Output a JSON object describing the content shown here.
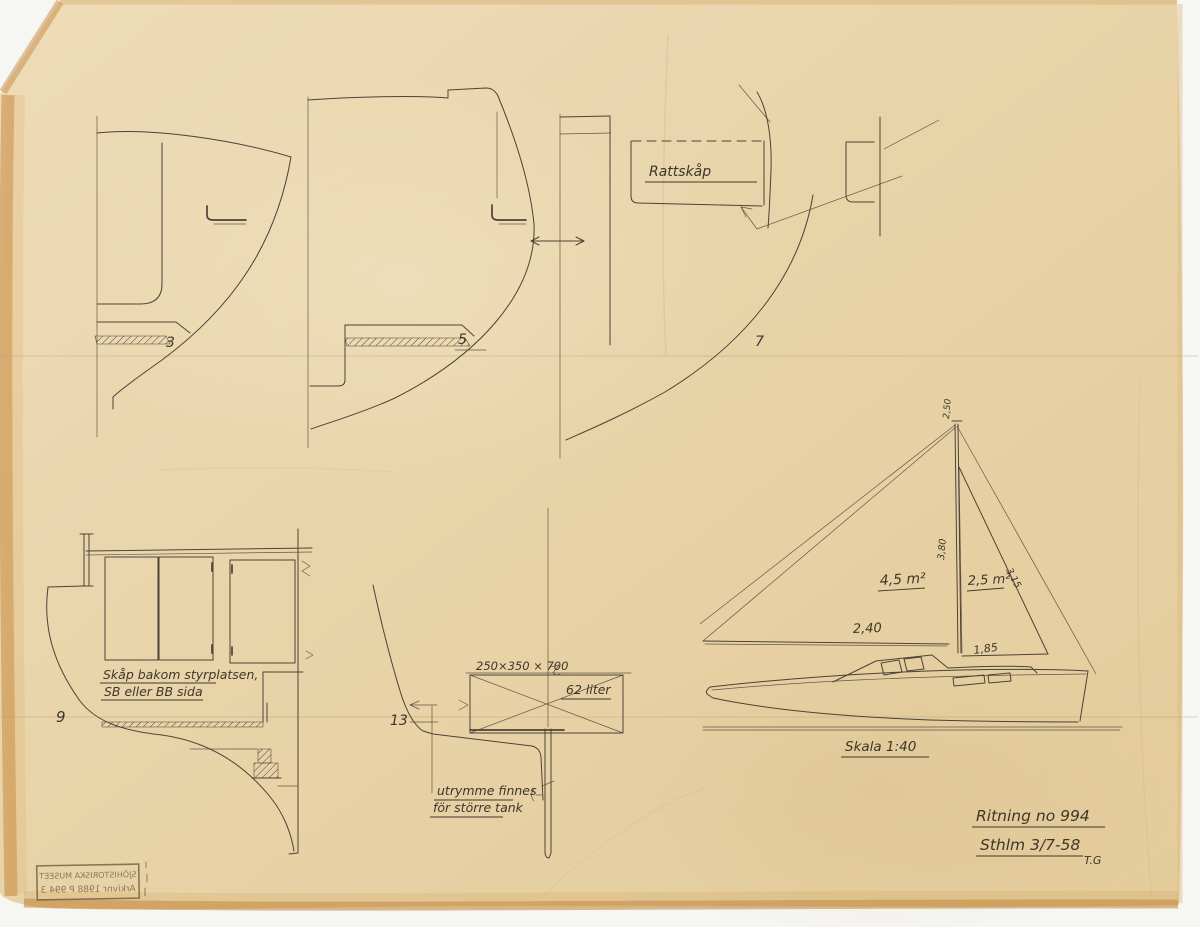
{
  "document": {
    "type": "Scanned hand-drawn boat construction drawing",
    "labels": {
      "rattskap": "Rattskåp",
      "skala": "Skala 1:40",
      "ritning": "Ritning no 994",
      "date": "Sthlm 3/7-58",
      "initials": "T.G",
      "cabinet_note_1": "Skåp bakom styrplatsen,",
      "cabinet_note_2": "SB eller BB sida",
      "tank_dim": "250×350 × 700",
      "tank_volume": "62 liter",
      "tank_note_1": "utrymme finnes",
      "tank_note_2": "för större tank"
    },
    "sections": {
      "s3": "3",
      "s5": "5",
      "s7": "7",
      "s9": "9",
      "s13": "13"
    },
    "sail_plan": {
      "main_area": "4,5 m²",
      "aft_area": "2,5 m²",
      "mast": "3,80",
      "topmast": "2,50",
      "stay": "3,15",
      "fore_boom": "2,40",
      "aft_boom": "1,85"
    },
    "stamp": {
      "line1": "SJÖHISTORISKA MUSEET",
      "line2": "Arkivnr 1988 P 994 3"
    },
    "colors": {
      "paper": "#e9d4a9",
      "pencil": "#4d4237",
      "edge": "#c28136",
      "scan_background": "#f6f6f3"
    }
  }
}
